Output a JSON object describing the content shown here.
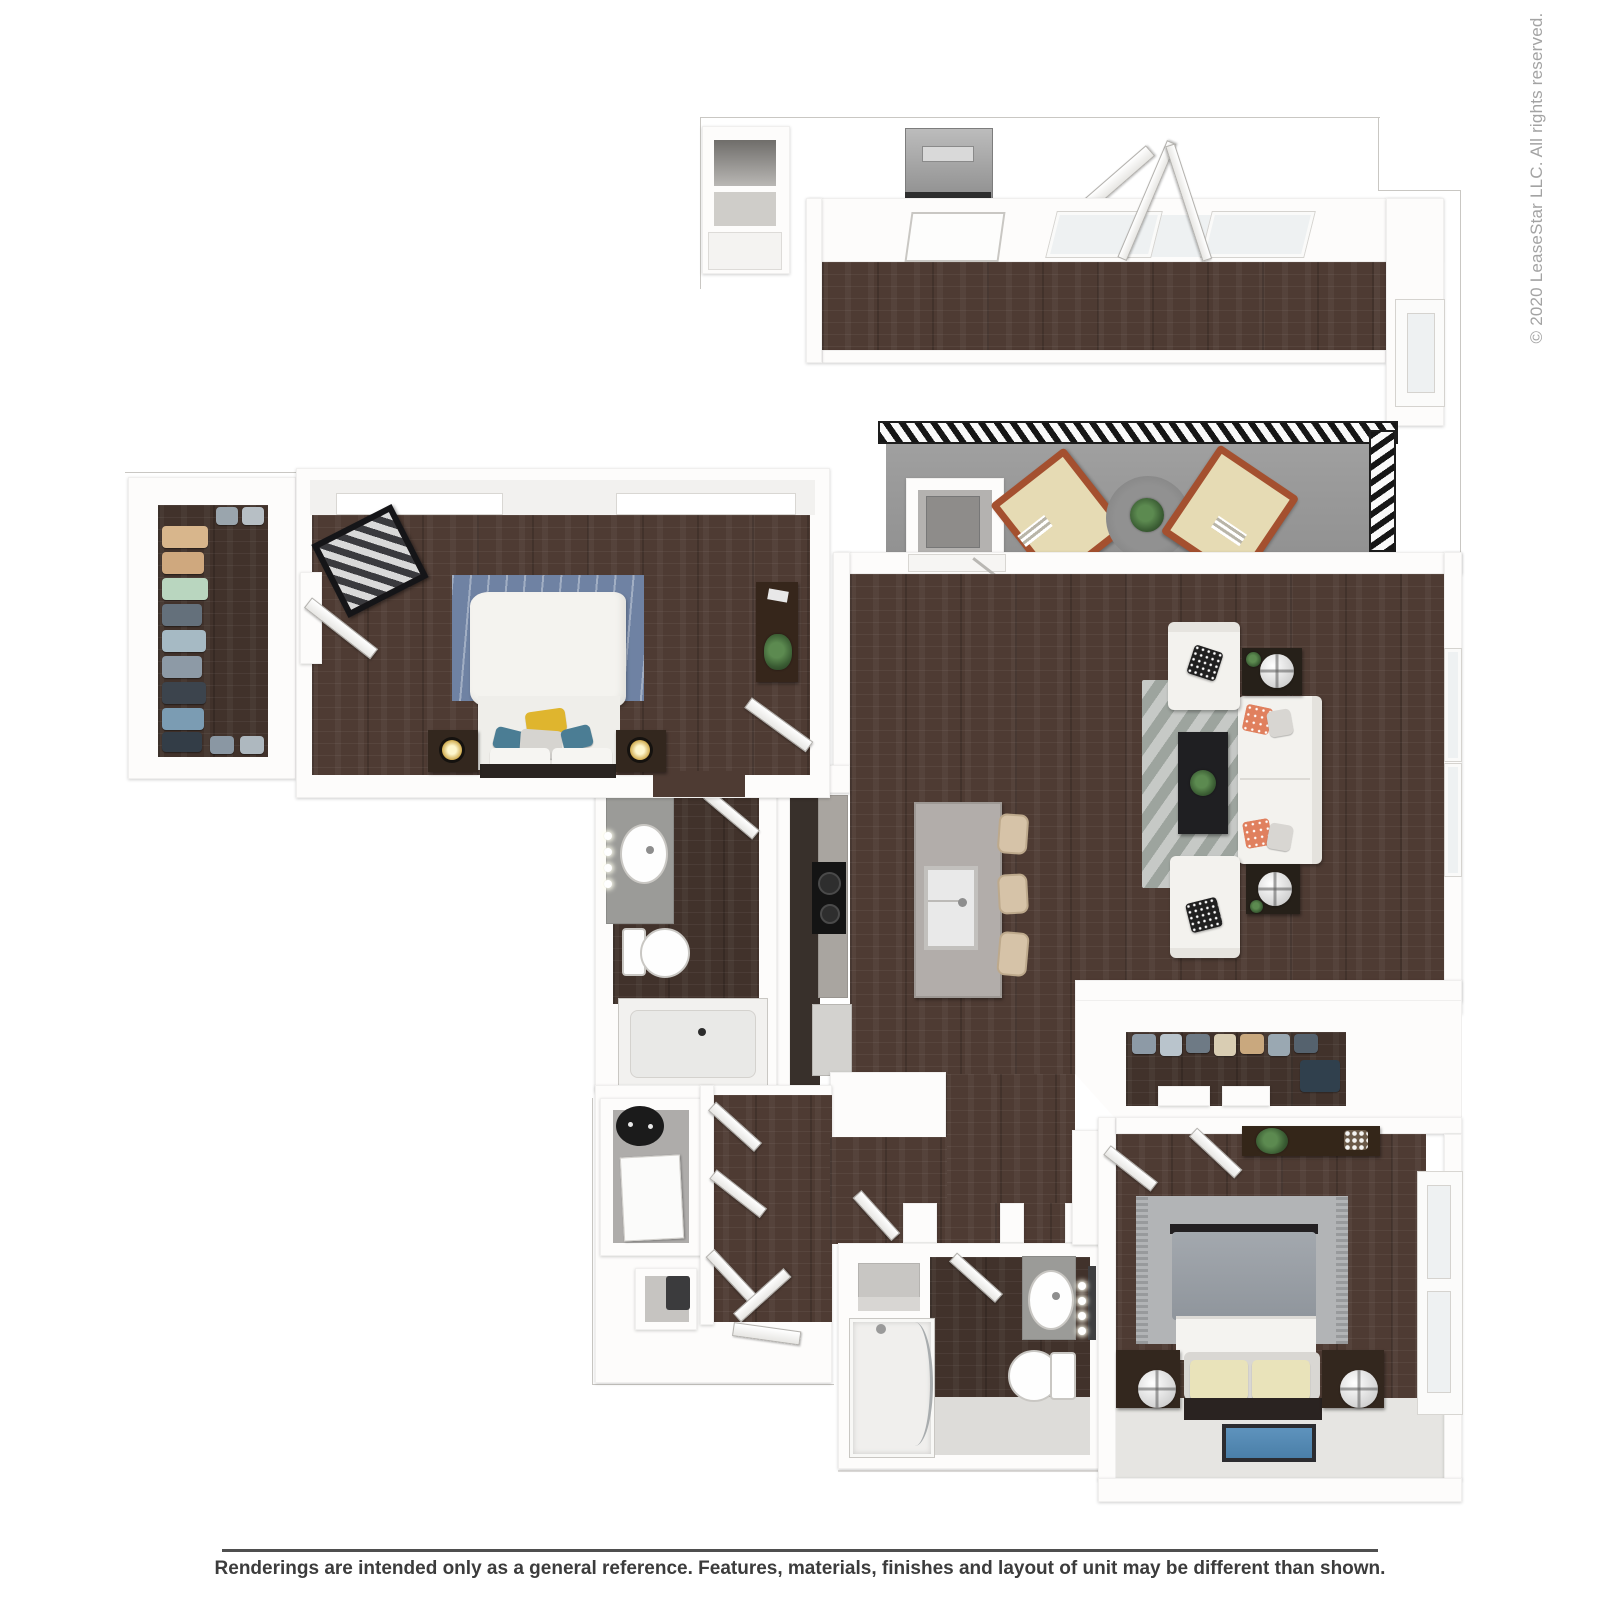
{
  "page": {
    "copyright": "© 2020 LeaseStar LLC. All rights reserved.",
    "disclaimer": "Renderings are intended only as a general reference. Features, materials, finishes and layout of unit may be different than shown."
  },
  "colors": {
    "wood": "#4e3b33",
    "wood_dark": "#41322b",
    "wall": "#fdfcfb",
    "wall_edge": "#d9d7d3",
    "outline": "#c9c7c3",
    "balcony_floor": "#9b9b9b",
    "railing": "#1d1d1d",
    "counter": "#a9a5a0",
    "island": "#b2adaa",
    "cabinet_dark": "#38302b",
    "appliance_black": "#141414",
    "rug_blue": "#6f82a3",
    "rug_chevron_light": "#c6c9c6",
    "rug_chevron_dark": "#9da49e",
    "rug_gray": "#b2b4b6",
    "sofa_white": "#f3f2ee",
    "pillow_coral": "#e0805e",
    "pillow_yellow": "#dfb52e",
    "pillow_teal": "#4b7d94",
    "pillow_cream": "#e9e3ba",
    "furniture_dark": "#33271e",
    "lamp_gold": "#caa23f",
    "plant_green": "#3a5c33",
    "mat_blue": "#4a7fa8",
    "fixture_gray": "#9b9b98",
    "tile_light": "#dddcd9",
    "footer_line": "#4f4f4f",
    "footer_text": "#3c3c3c",
    "copyright_text": "#a3a3a3"
  }
}
